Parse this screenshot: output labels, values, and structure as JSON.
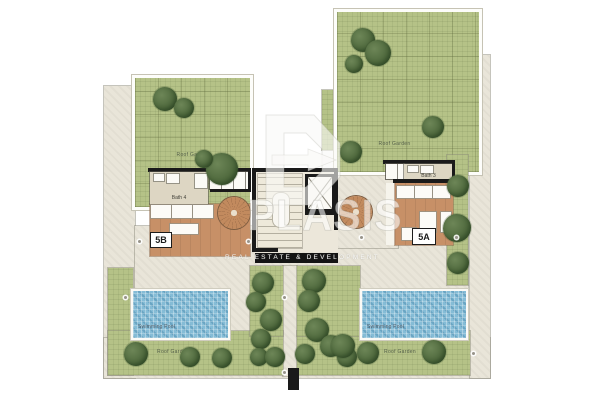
{
  "labels": {
    "roof_garden": "Roof Garden",
    "swimming_pool": "Swimming Pool"
  },
  "units": [
    {
      "id": "5B",
      "bath": "Bath 4"
    },
    {
      "id": "5A",
      "bath": "Bath 3"
    }
  ],
  "watermark": {
    "brand": "PLASIS",
    "tagline": "REAL ESTATE & DEVELOPMENT"
  },
  "colors": {
    "garden": "#b5c287",
    "terrace": "#e9e5d9",
    "wood_deck": "#c79067",
    "pool": "#85bcd6",
    "wall": "#1a1a1a",
    "tree": "#4a6238"
  },
  "trees": [
    {
      "x": 165,
      "y": 99,
      "r": 12
    },
    {
      "x": 184,
      "y": 108,
      "r": 10
    },
    {
      "x": 222,
      "y": 169,
      "r": 16
    },
    {
      "x": 204,
      "y": 159,
      "r": 9
    },
    {
      "x": 363,
      "y": 40,
      "r": 12
    },
    {
      "x": 378,
      "y": 53,
      "r": 13
    },
    {
      "x": 354,
      "y": 64,
      "r": 9
    },
    {
      "x": 433,
      "y": 127,
      "r": 11
    },
    {
      "x": 351,
      "y": 152,
      "r": 11
    },
    {
      "x": 458,
      "y": 186,
      "r": 11
    },
    {
      "x": 457,
      "y": 228,
      "r": 14
    },
    {
      "x": 458,
      "y": 263,
      "r": 11
    },
    {
      "x": 136,
      "y": 354,
      "r": 12
    },
    {
      "x": 190,
      "y": 357,
      "r": 10
    },
    {
      "x": 222,
      "y": 358,
      "r": 10
    },
    {
      "x": 263,
      "y": 283,
      "r": 11
    },
    {
      "x": 256,
      "y": 302,
      "r": 10
    },
    {
      "x": 271,
      "y": 320,
      "r": 11
    },
    {
      "x": 261,
      "y": 339,
      "r": 10
    },
    {
      "x": 259,
      "y": 357,
      "r": 9
    },
    {
      "x": 275,
      "y": 357,
      "r": 10
    },
    {
      "x": 314,
      "y": 281,
      "r": 12
    },
    {
      "x": 309,
      "y": 301,
      "r": 11
    },
    {
      "x": 317,
      "y": 330,
      "r": 12
    },
    {
      "x": 305,
      "y": 354,
      "r": 10
    },
    {
      "x": 331,
      "y": 346,
      "r": 11
    },
    {
      "x": 347,
      "y": 357,
      "r": 10
    },
    {
      "x": 343,
      "y": 346,
      "r": 12
    },
    {
      "x": 368,
      "y": 353,
      "r": 11
    },
    {
      "x": 434,
      "y": 352,
      "r": 12
    }
  ],
  "markers": [
    {
      "x": 138,
      "y": 240
    },
    {
      "x": 247,
      "y": 240
    },
    {
      "x": 360,
      "y": 236
    },
    {
      "x": 455,
      "y": 236
    },
    {
      "x": 124,
      "y": 296
    },
    {
      "x": 283,
      "y": 296
    },
    {
      "x": 283,
      "y": 371
    },
    {
      "x": 472,
      "y": 352
    }
  ]
}
